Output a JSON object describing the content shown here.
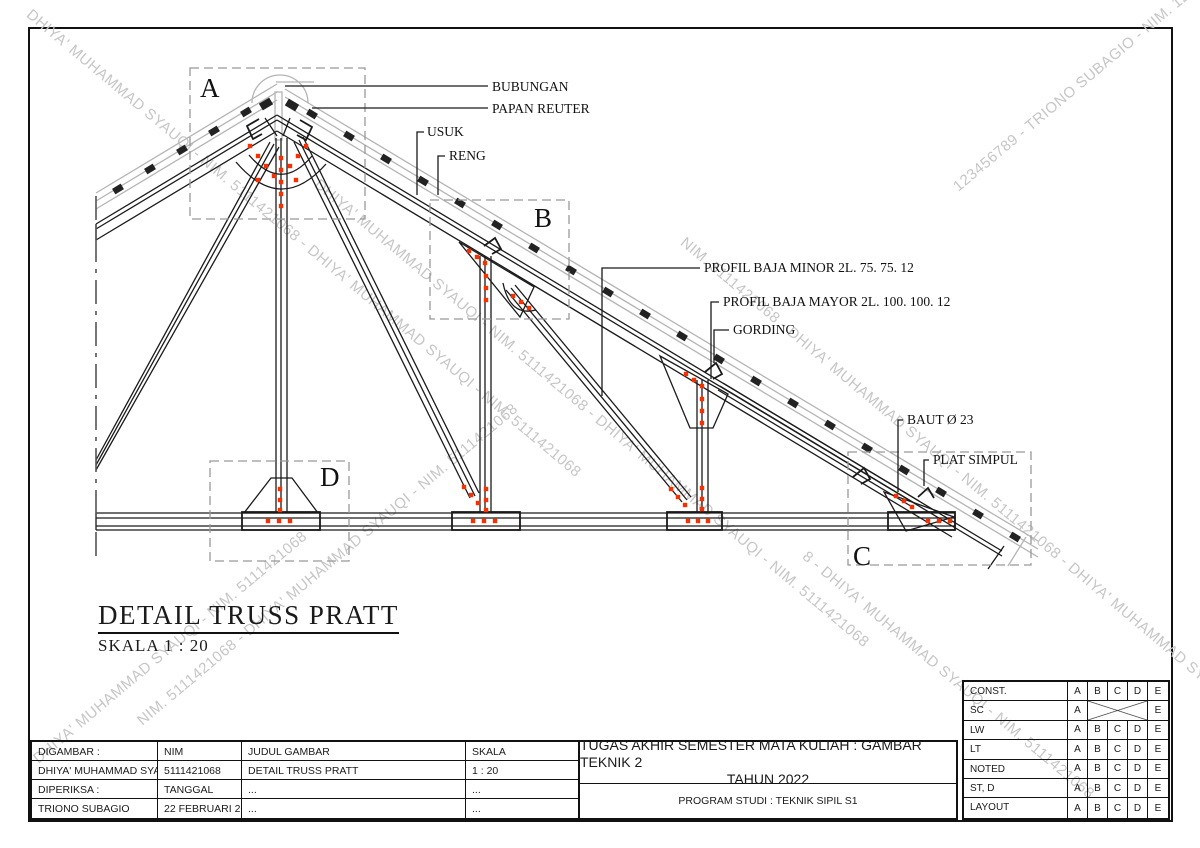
{
  "drawing": {
    "title": "DETAIL TRUSS PRATT",
    "scale": "SKALA 1 : 20",
    "details": {
      "a": "A",
      "b": "B",
      "c": "C",
      "d": "D"
    },
    "annotations": {
      "bubungan": "BUBUNGAN",
      "papan_reuter": "PAPAN REUTER",
      "usuk": "USUK",
      "reng": "RENG",
      "profil_minor": "PROFIL BAJA MINOR 2L. 75. 75. 12",
      "profil_mayor": "PROFIL BAJA MAYOR 2L. 100. 100. 12",
      "gording": "GORDING",
      "baut": "BAUT Ø 23",
      "plat_simpul": "PLAT SIMPUL"
    }
  },
  "watermarks": [
    "DHIYA' MUHAMMAD SYAUQI - NIM. 5111421068 - DHIYA' MUHAMMAD SYAUQI - NIM. 5111421068",
    "DHIYA' MUHAMMAD SYAUQI - NIM. 5111421068 - DHIYA' MUHAMMAD SYAUQI - NIM. 5111421068",
    "NIM. 5111421068 - DHIYA' MUHAMMAD SYAUQI - NIM. 5111421068 - DHIYA' MUHAMMAD SYAUQI",
    "123456789 - TRIONO SUBAGIO - NIM. 123456789",
    "DHIYA' MUHAMMAD SYAUQI - NIM. 5111421068",
    "NIM. 5111421068 - DHIYA' MUHAMMAD SYAUQI - NIM. 5111421068",
    "8 - DHIYA' MUHAMMAD SYAUQI - NIM. 5111421068"
  ],
  "title_block": {
    "left": {
      "rows": [
        [
          "DIGAMBAR :",
          "NIM",
          "JUDUL GAMBAR",
          "SKALA"
        ],
        [
          "DHIYA' MUHAMMAD SYAUQI",
          "5111421068",
          "DETAIL TRUSS PRATT",
          "1 : 20"
        ],
        [
          "DIPERIKSA :",
          "TANGGAL",
          "...",
          "..."
        ],
        [
          "TRIONO SUBAGIO",
          "22 FEBRUARI 2022",
          "...",
          "..."
        ]
      ]
    },
    "center": {
      "line1": "TUGAS AKHIR SEMESTER MATA KULIAH : GAMBAR TEKNIK 2",
      "line2": "TAHUN 2022",
      "program": "PROGRAM STUDI : TEKNIK SIPIL S1"
    },
    "revision": {
      "rows": [
        {
          "label": "CONST.",
          "cells": [
            "A",
            "B",
            "C",
            "D",
            "E"
          ]
        },
        {
          "label": "SC",
          "cells": [
            "A",
            "E"
          ],
          "crossed": true
        },
        {
          "label": "LW",
          "cells": [
            "A",
            "B",
            "C",
            "D",
            "E"
          ]
        },
        {
          "label": "LT",
          "cells": [
            "A",
            "B",
            "C",
            "D",
            "E"
          ]
        },
        {
          "label": "NOTED",
          "cells": [
            "A",
            "B",
            "C",
            "D",
            "E"
          ]
        },
        {
          "label": "ST, D",
          "cells": [
            "A",
            "B",
            "C",
            "D",
            "E"
          ]
        },
        {
          "label": "LAYOUT",
          "cells": [
            "A",
            "B",
            "C",
            "D",
            "E"
          ]
        }
      ]
    }
  },
  "colors": {
    "bolt": "#f63000",
    "roof": "#b4b4b4",
    "watermark": "#c6c6c6",
    "line": "#1a1a1a"
  }
}
